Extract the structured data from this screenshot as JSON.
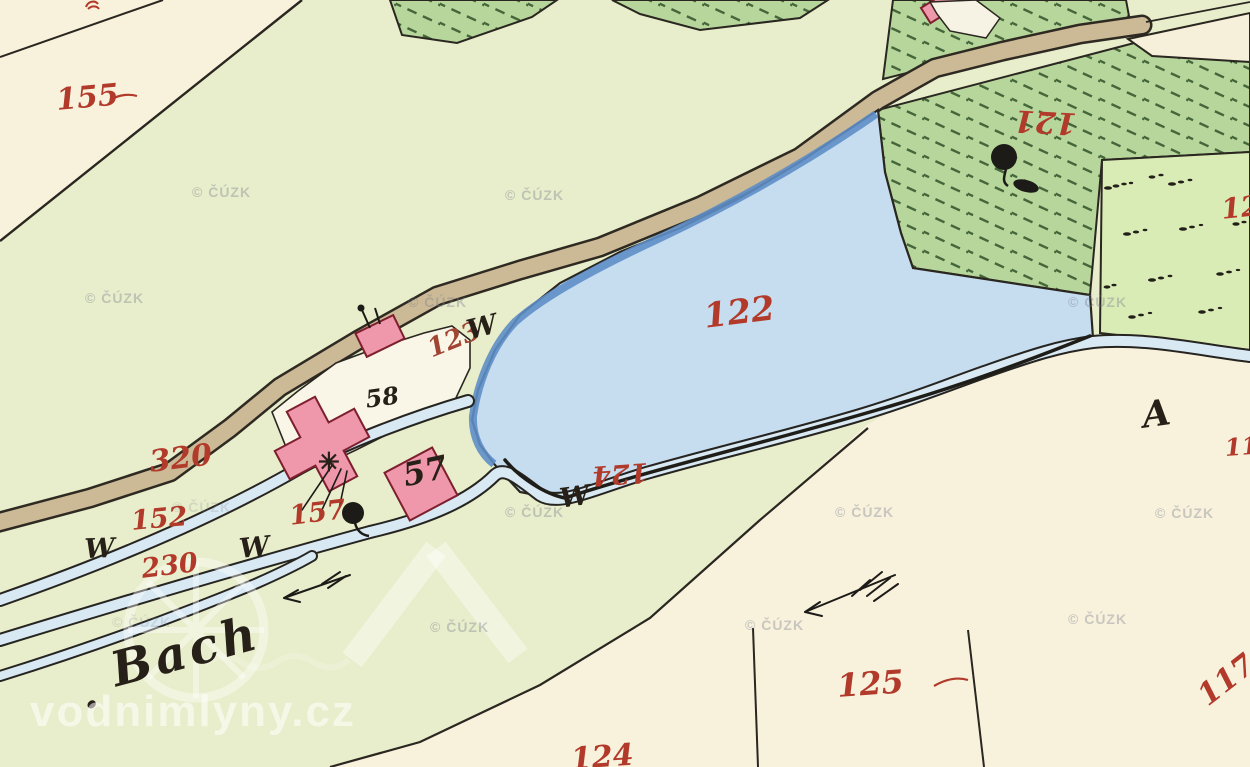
{
  "attribution": {
    "cuzk": "© ČÚZK",
    "site": "vodnimlyny.cz"
  },
  "stream": {
    "dot": ".",
    "name": "Bach"
  },
  "section_letter": "A",
  "symbols": {
    "meadow_w": "W",
    "chapel_star": "✳"
  },
  "house_numbers": [
    "58",
    "57"
  ],
  "parcel_numbers": [
    "155",
    "121",
    "122",
    "123",
    "124",
    "320",
    "152",
    "230",
    "157",
    "125",
    "124",
    "12",
    "11",
    "117"
  ],
  "colors": {
    "field_green": "#e8eecb",
    "cream": "#f8f2dd",
    "hatched_parcel_fill": "#b7d69b",
    "hatch_line_green": "#45663a",
    "dotted_parcel_fill": "#daecb6",
    "pond_blue": "#c6ddf0",
    "pond_edge_blue": "#5e8ec7",
    "stream_blue": "#d8e9f3",
    "road_tan": "#ccba96",
    "building_pink": "#ef97ab",
    "building_outline": "#7d1f2d",
    "label_red": "#b23a2b",
    "ink_black": "#262420",
    "watermark_gray": "#7a7e8e",
    "site_watermark_white": "#ffffff"
  }
}
